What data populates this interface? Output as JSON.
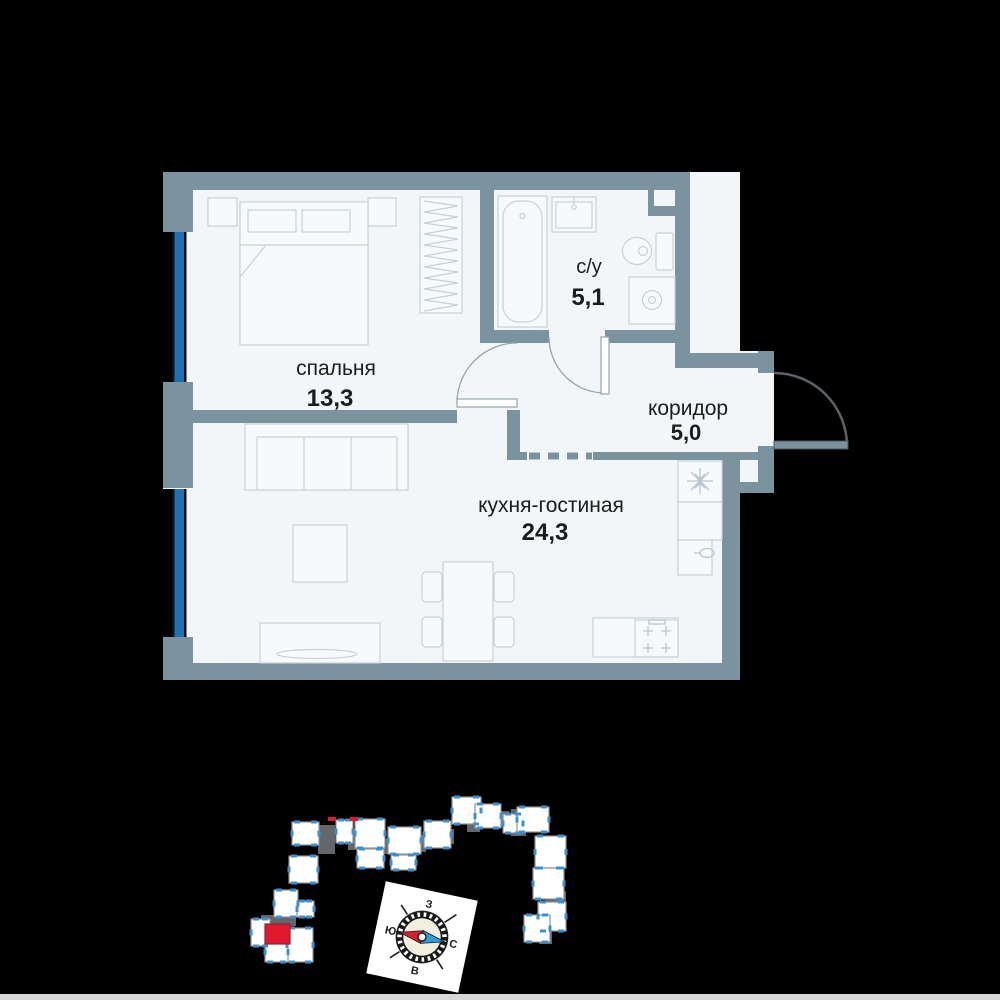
{
  "scene": {
    "background": "#000000",
    "bottom_strip_color": "#D6D6D6"
  },
  "floor_plan": {
    "rooms": [
      {
        "id": "bedroom",
        "name": "спальня",
        "area": "13,3"
      },
      {
        "id": "bathroom",
        "name": "с/у",
        "area": "5,1"
      },
      {
        "id": "corridor",
        "name": "коридор",
        "area": "5,0"
      },
      {
        "id": "kitchen_living",
        "name": "кухня-гостиная",
        "area": "24,3"
      }
    ],
    "colors": {
      "wall": "#7B929F",
      "floor": "#F2F6F9",
      "window_glass": "#1B72B8",
      "furniture_line": "#C7D1D8",
      "door_swing": "#97A5AE",
      "entrance_door": "#5A6166",
      "label_text": "#1C1C1A"
    }
  },
  "site_plan": {
    "highlight_color": "#E0192D",
    "block_fill": "#FFFFFF",
    "block_stroke": "#8E9296",
    "core_fill": "#63676B",
    "window_tick_color": "#3F8FCD",
    "blocks": [
      [
        292,
        822,
        27,
        23
      ],
      [
        336,
        820,
        17,
        23
      ],
      [
        355,
        819,
        30,
        29
      ],
      [
        357,
        849,
        27,
        19
      ],
      [
        388,
        827,
        33,
        27
      ],
      [
        391,
        855,
        25,
        15
      ],
      [
        424,
        821,
        27,
        27
      ],
      [
        452,
        797,
        29,
        27
      ],
      [
        475,
        804,
        26,
        24
      ],
      [
        503,
        814,
        20,
        19
      ],
      [
        517,
        807,
        32,
        25
      ],
      [
        535,
        836,
        31,
        32
      ],
      [
        533,
        868,
        31,
        31
      ],
      [
        538,
        902,
        28,
        29
      ],
      [
        524,
        915,
        26,
        27
      ],
      [
        289,
        856,
        29,
        27
      ],
      [
        274,
        890,
        24,
        27
      ],
      [
        297,
        901,
        17,
        16
      ],
      [
        251,
        919,
        19,
        27
      ],
      [
        287,
        928,
        26,
        34
      ],
      [
        265,
        942,
        23,
        20
      ]
    ],
    "cores": [
      [
        318,
        825,
        17,
        29
      ],
      [
        348,
        835,
        11,
        15
      ],
      [
        380,
        839,
        13,
        15
      ],
      [
        414,
        835,
        12,
        17
      ],
      [
        443,
        829,
        11,
        15
      ],
      [
        467,
        815,
        13,
        17
      ],
      [
        496,
        811,
        13,
        15
      ],
      [
        511,
        809,
        15,
        27
      ],
      [
        541,
        857,
        11,
        13
      ],
      [
        545,
        891,
        21,
        19
      ],
      [
        281,
        905,
        15,
        21
      ],
      [
        261,
        915,
        25,
        12
      ],
      [
        291,
        937,
        11,
        17
      ],
      [
        539,
        929,
        13,
        15
      ]
    ],
    "highlighted_unit": [
      265,
      924,
      25,
      20
    ],
    "red_ticks": [
      [
        328,
        817,
        8,
        4
      ],
      [
        350,
        817,
        8,
        4
      ]
    ],
    "compass": {
      "top": "З",
      "left": "Ю",
      "right": "С",
      "bottom": "В",
      "needle_left_color": "#D81F2E",
      "needle_right_color": "#2D9FD8",
      "face_color": "#F3EFDE",
      "rotation_deg": 12
    }
  }
}
